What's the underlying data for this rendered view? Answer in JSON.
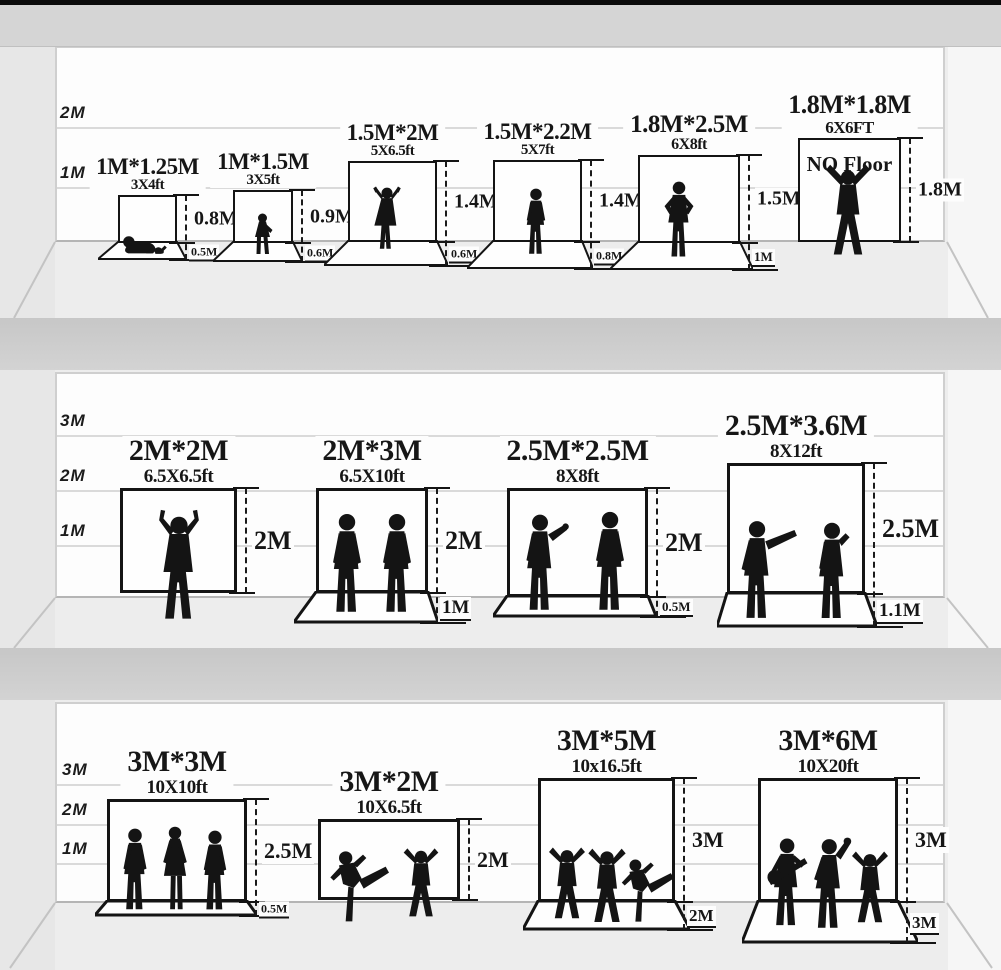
{
  "colors": {
    "ink": "#141414",
    "wall_white": "#fdfdfd",
    "floor_gray": "#ededed",
    "separator_gray": "#c9c9c9",
    "top_bar_black": "#0b0b0b"
  },
  "shelves": [
    {
      "axis_labels": [
        "2M",
        "1M"
      ],
      "backdrops": [
        {
          "title": "1M*1.25M",
          "subtitle": "3X4ft",
          "height_label": "0.8M",
          "floor_label": "0.5M",
          "figures": [
            "baby-crawling-figure"
          ]
        },
        {
          "title": "1M*1.5M",
          "subtitle": "3X5ft",
          "height_label": "0.9M",
          "floor_label": "0.6M",
          "figures": [
            "toddler-figure"
          ]
        },
        {
          "title": "1.5M*2M",
          "subtitle": "5X6.5ft",
          "height_label": "1.4M",
          "floor_label": "0.6M",
          "figures": [
            "child-arms-up-figure"
          ]
        },
        {
          "title": "1.5M*2.2M",
          "subtitle": "5X7ft",
          "height_label": "1.4M",
          "floor_label": "0.8M",
          "figures": [
            "child-standing-figure"
          ]
        },
        {
          "title": "1.8M*2.5M",
          "subtitle": "6X8ft",
          "height_label": "1.5M",
          "floor_label": "1M",
          "figures": [
            "teen-hands-on-hips-figure"
          ]
        },
        {
          "title": "1.8M*1.8M",
          "subtitle": "6X6FT",
          "height_label": "1.8M",
          "interior_label": "NO Floor",
          "figures": [
            "man-cheering-figure"
          ]
        }
      ]
    },
    {
      "axis_labels": [
        "3M",
        "2M",
        "1M"
      ],
      "backdrops": [
        {
          "title": "2M*2M",
          "subtitle": "6.5X6.5ft",
          "height_label": "2M",
          "figures": [
            "man-victory-figure"
          ]
        },
        {
          "title": "2M*3M",
          "subtitle": "6.5X10ft",
          "height_label": "2M",
          "floor_label": "1M",
          "figures": [
            "man-standing-figure",
            "man-standing-figure"
          ]
        },
        {
          "title": "2.5M*2.5M",
          "subtitle": "8X8ft",
          "height_label": "2M",
          "floor_label": "0.5M",
          "figures": [
            "man-gesturing-figure",
            "man-standing-figure"
          ]
        },
        {
          "title": "2.5M*3.6M",
          "subtitle": "8X12ft",
          "height_label": "2.5M",
          "floor_label": "1.1M",
          "figures": [
            "man-pointing-figure",
            "man-phone-figure"
          ]
        }
      ]
    },
    {
      "axis_labels": [
        "3M",
        "2M",
        "1M"
      ],
      "backdrops": [
        {
          "title": "3M*3M",
          "subtitle": "10X10ft",
          "height_label": "2.5M",
          "floor_label": "0.5M",
          "figures": [
            "man-standing-figure",
            "woman-standing-figure",
            "man-standing-figure"
          ]
        },
        {
          "title": "3M*2M",
          "subtitle": "10X6.5ft",
          "height_label": "2M",
          "figures": [
            "dancer-kick-figure",
            "dancer-arms-up-figure"
          ]
        },
        {
          "title": "3M*5M",
          "subtitle": "10x16.5ft",
          "height_label": "3M",
          "floor_label": "2M",
          "figures": [
            "dancer-arms-up-figure",
            "dancer-arms-up-figure",
            "dancer-kick-figure"
          ]
        },
        {
          "title": "3M*6M",
          "subtitle": "10X20ft",
          "height_label": "3M",
          "floor_label": "3M",
          "figures": [
            "guitarist-figure",
            "singer-figure",
            "dancer-arms-up-figure"
          ]
        }
      ]
    }
  ]
}
